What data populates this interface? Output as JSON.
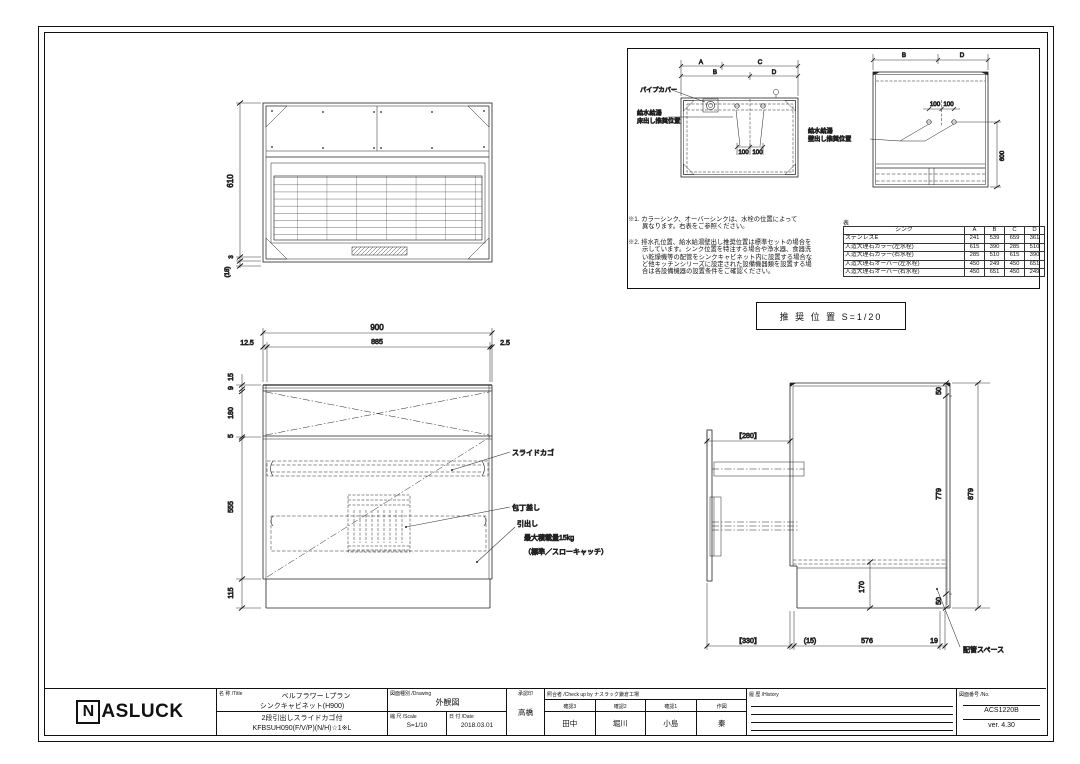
{
  "detail_panel": {
    "floor_view": {
      "dims": {
        "A": "A",
        "B": "B",
        "C": "C",
        "D": "D",
        "d100_left": "100",
        "d100_right": "100"
      },
      "labels": {
        "pipe_cover": "パイプカバー",
        "supply_line1": "給水給湯",
        "supply_line2": "床出し推奨位置"
      }
    },
    "wall_view": {
      "dims": {
        "B": "B",
        "D": "D",
        "d100_left": "100",
        "d100_right": "100",
        "h600": "600"
      },
      "labels": {
        "supply_line1": "給水給湯",
        "supply_line2": "壁出し推奨位置"
      }
    },
    "notes": {
      "note1_lines": [
        "※1. カラーシンク、オーバーシンクは、水栓の位置によって",
        "異なります。右表をご参照ください。"
      ],
      "note2_lines": [
        "※2. 排水孔位置、給水給湯壁出し推奨位置は標準セットの場合を",
        "示しています。シンク位置を特注する場合や浄水器、食器洗",
        "い乾燥機等の配管をシンクキャビネット内に設置する場合な",
        "ど他キッチンシリーズに設定された設備機器類を設置する場",
        "合は各設備機器の設置条件をご確認ください。"
      ]
    },
    "table": {
      "caption": "表",
      "headers": [
        "シンク",
        "A",
        "B",
        "C",
        "D"
      ],
      "rows": [
        [
          "ステンレスE",
          "241",
          "539",
          "659",
          "361"
        ],
        [
          "人造大理石カラー(左水栓)",
          "615",
          "390",
          "285",
          "510"
        ],
        [
          "人造大理石カラー(右水栓)",
          "285",
          "510",
          "615",
          "390"
        ],
        [
          "人造大理石オーバー(左水栓)",
          "450",
          "249",
          "450",
          "651"
        ],
        [
          "人造大理石オーバー(右水栓)",
          "450",
          "651",
          "450",
          "249"
        ]
      ]
    },
    "recommended_label": "推 奨 位 置  S=1/20"
  },
  "plan_view": {
    "dims": {
      "depth": "610",
      "gap": "3",
      "overhang": "(18)"
    }
  },
  "front_view": {
    "dims": {
      "width": "900",
      "left_gap": "12.5",
      "inner": "885",
      "right_gap": "2.5",
      "h15": "15",
      "h9": "9",
      "h180": "180",
      "h5": "5",
      "h555": "555",
      "h115": "115"
    },
    "labels": {
      "slide_basket": "スライドカゴ",
      "knife_holder": "包丁差し",
      "drawer": "引出し",
      "max_load": "最大積載量15kg",
      "catch": "（標準／スローキャッチ）"
    }
  },
  "side_view": {
    "dims": {
      "ext280": "【280】",
      "top50": "50",
      "h779": "779",
      "h879": "879",
      "h170": "170",
      "bottom50": "50",
      "ext330": "【330】",
      "gap15": "(15)",
      "d576": "576",
      "d19": "19"
    },
    "labels": {
      "pipe_space": "配管スペース"
    }
  },
  "title_block": {
    "logo_n": "N",
    "logo": "ASLUCK",
    "title_header": "名 称 /Title",
    "title_line1": "ベルフラワー Lプラン",
    "title_line2": "シンクキャビネット(H900)",
    "title_line3": "2段引出しスライドカゴ付",
    "title_line4": "KFBSUH090(F/V/P)(N/H)☆1※L",
    "drawing_header": "図面種別 /Drawing",
    "drawing_type": "外観図",
    "scale_header": "縮 尺 /Scale",
    "scale_value": "S=1/10",
    "date_header": "日 付 /Date",
    "date_value": "2018.03.01",
    "approval_header": "承認印",
    "approval_name": "高橋",
    "check_header": "照合者 /Check up by ナスラック鎌倉工場",
    "check_cols": [
      {
        "header": "確認3",
        "name": "田中"
      },
      {
        "header": "確認2",
        "name": "堀川"
      },
      {
        "header": "確認1",
        "name": "小島"
      },
      {
        "header": "作図",
        "name": "秦"
      }
    ],
    "history_header": "履 歴 /History",
    "number_header": "図面番号 /No.",
    "number_value": "ACS1220B",
    "version": "ver. 4.30"
  }
}
